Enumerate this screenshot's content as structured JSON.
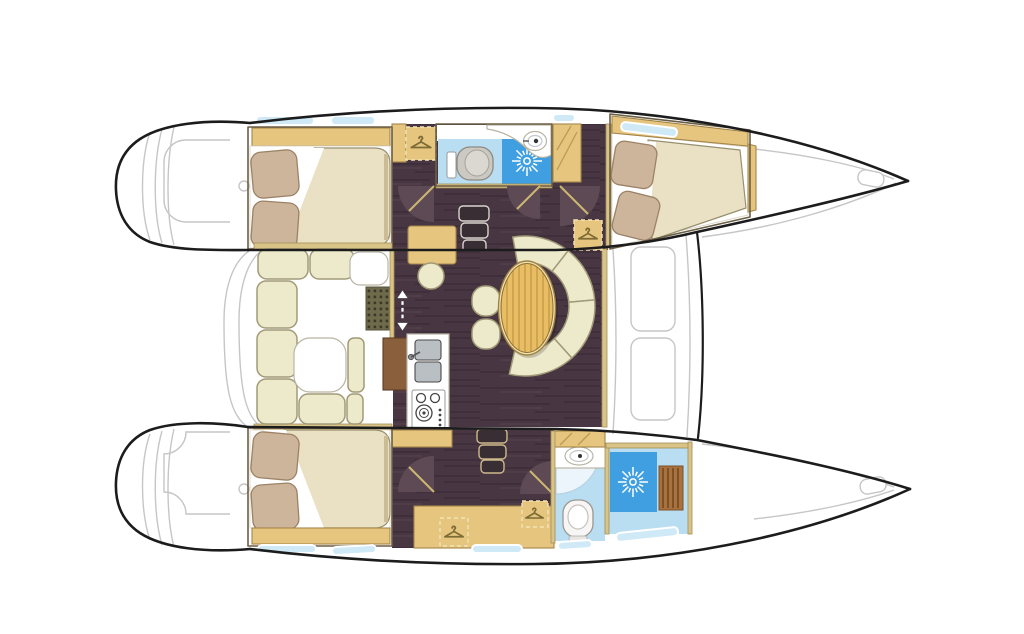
{
  "diagram": {
    "type": "yacht-floor-plan",
    "vessel": "catamaran",
    "view": "top-down interior layout",
    "description": "Top view floor plan of a catamaran sailing yacht interior",
    "canvas": {
      "width": 1024,
      "height": 634
    }
  },
  "colors": {
    "background": "#ffffff",
    "hull_outline": "#1c1c1c",
    "deck_line": "#c6c6c6",
    "wood_trim": "#e6c57e",
    "wood_trim_border": "#a3854a",
    "wall_tan": "#d9c488",
    "cushion": "#edeacb",
    "cushion_border": "#a19a78",
    "mattress": "#eae1c4",
    "mattress_shadow": "#cbbc96",
    "pillow": "#cdb59b",
    "pillow_border": "#9c8266",
    "floor_dark": "#483742",
    "floor_streak": "#362832",
    "door_swing": "#5d4a54",
    "door_leaf": "#cbb573",
    "bath_floor": "#b9ddf1",
    "shower_blue": "#3f9fe0",
    "window_glass": "#cfe9f6",
    "toilet_gray": "#ccc8c2",
    "sink_gray": "#b9bfc3",
    "teak_bench": "#a8713d",
    "teak_slat": "#7d5128",
    "mat_olive": "#6e6a4b",
    "table_wood": "#e9bd63",
    "table_grain": "#c99f4e",
    "galley_wood": "#8a5f3c"
  },
  "legend": {
    "orientation": {
      "bow": "right",
      "stern": "left"
    },
    "hulls": [
      {
        "name": "top-hull",
        "rooms": [
          "aft-double-cabin",
          "head-with-shower",
          "forward-double-cabin"
        ]
      },
      {
        "name": "bottom-hull",
        "rooms": [
          "aft-double-cabin",
          "head",
          "separate-shower-room"
        ]
      }
    ],
    "bridgedeck": {
      "rooms": [
        "cockpit-u-settee",
        "salon-dining",
        "galley",
        "nav-station"
      ]
    },
    "fixtures": [
      "double-berth",
      "pillows",
      "hull-windows",
      "wardrobe-hanger-locker",
      "toilet",
      "washbasin",
      "shower-rose",
      "teak-shower-bench",
      "companionway-steps",
      "door-swing",
      "oval-dining-table",
      "curved-settee",
      "dining-stools",
      "cockpit-table",
      "galley-double-sink",
      "stove-burners",
      "floor-grate",
      "transom-steps",
      "anchor-locker",
      "foredeck-hatches"
    ],
    "icons": [
      "hanger-icon",
      "shower-rose-icon",
      "up-down-stairs-icon"
    ]
  }
}
